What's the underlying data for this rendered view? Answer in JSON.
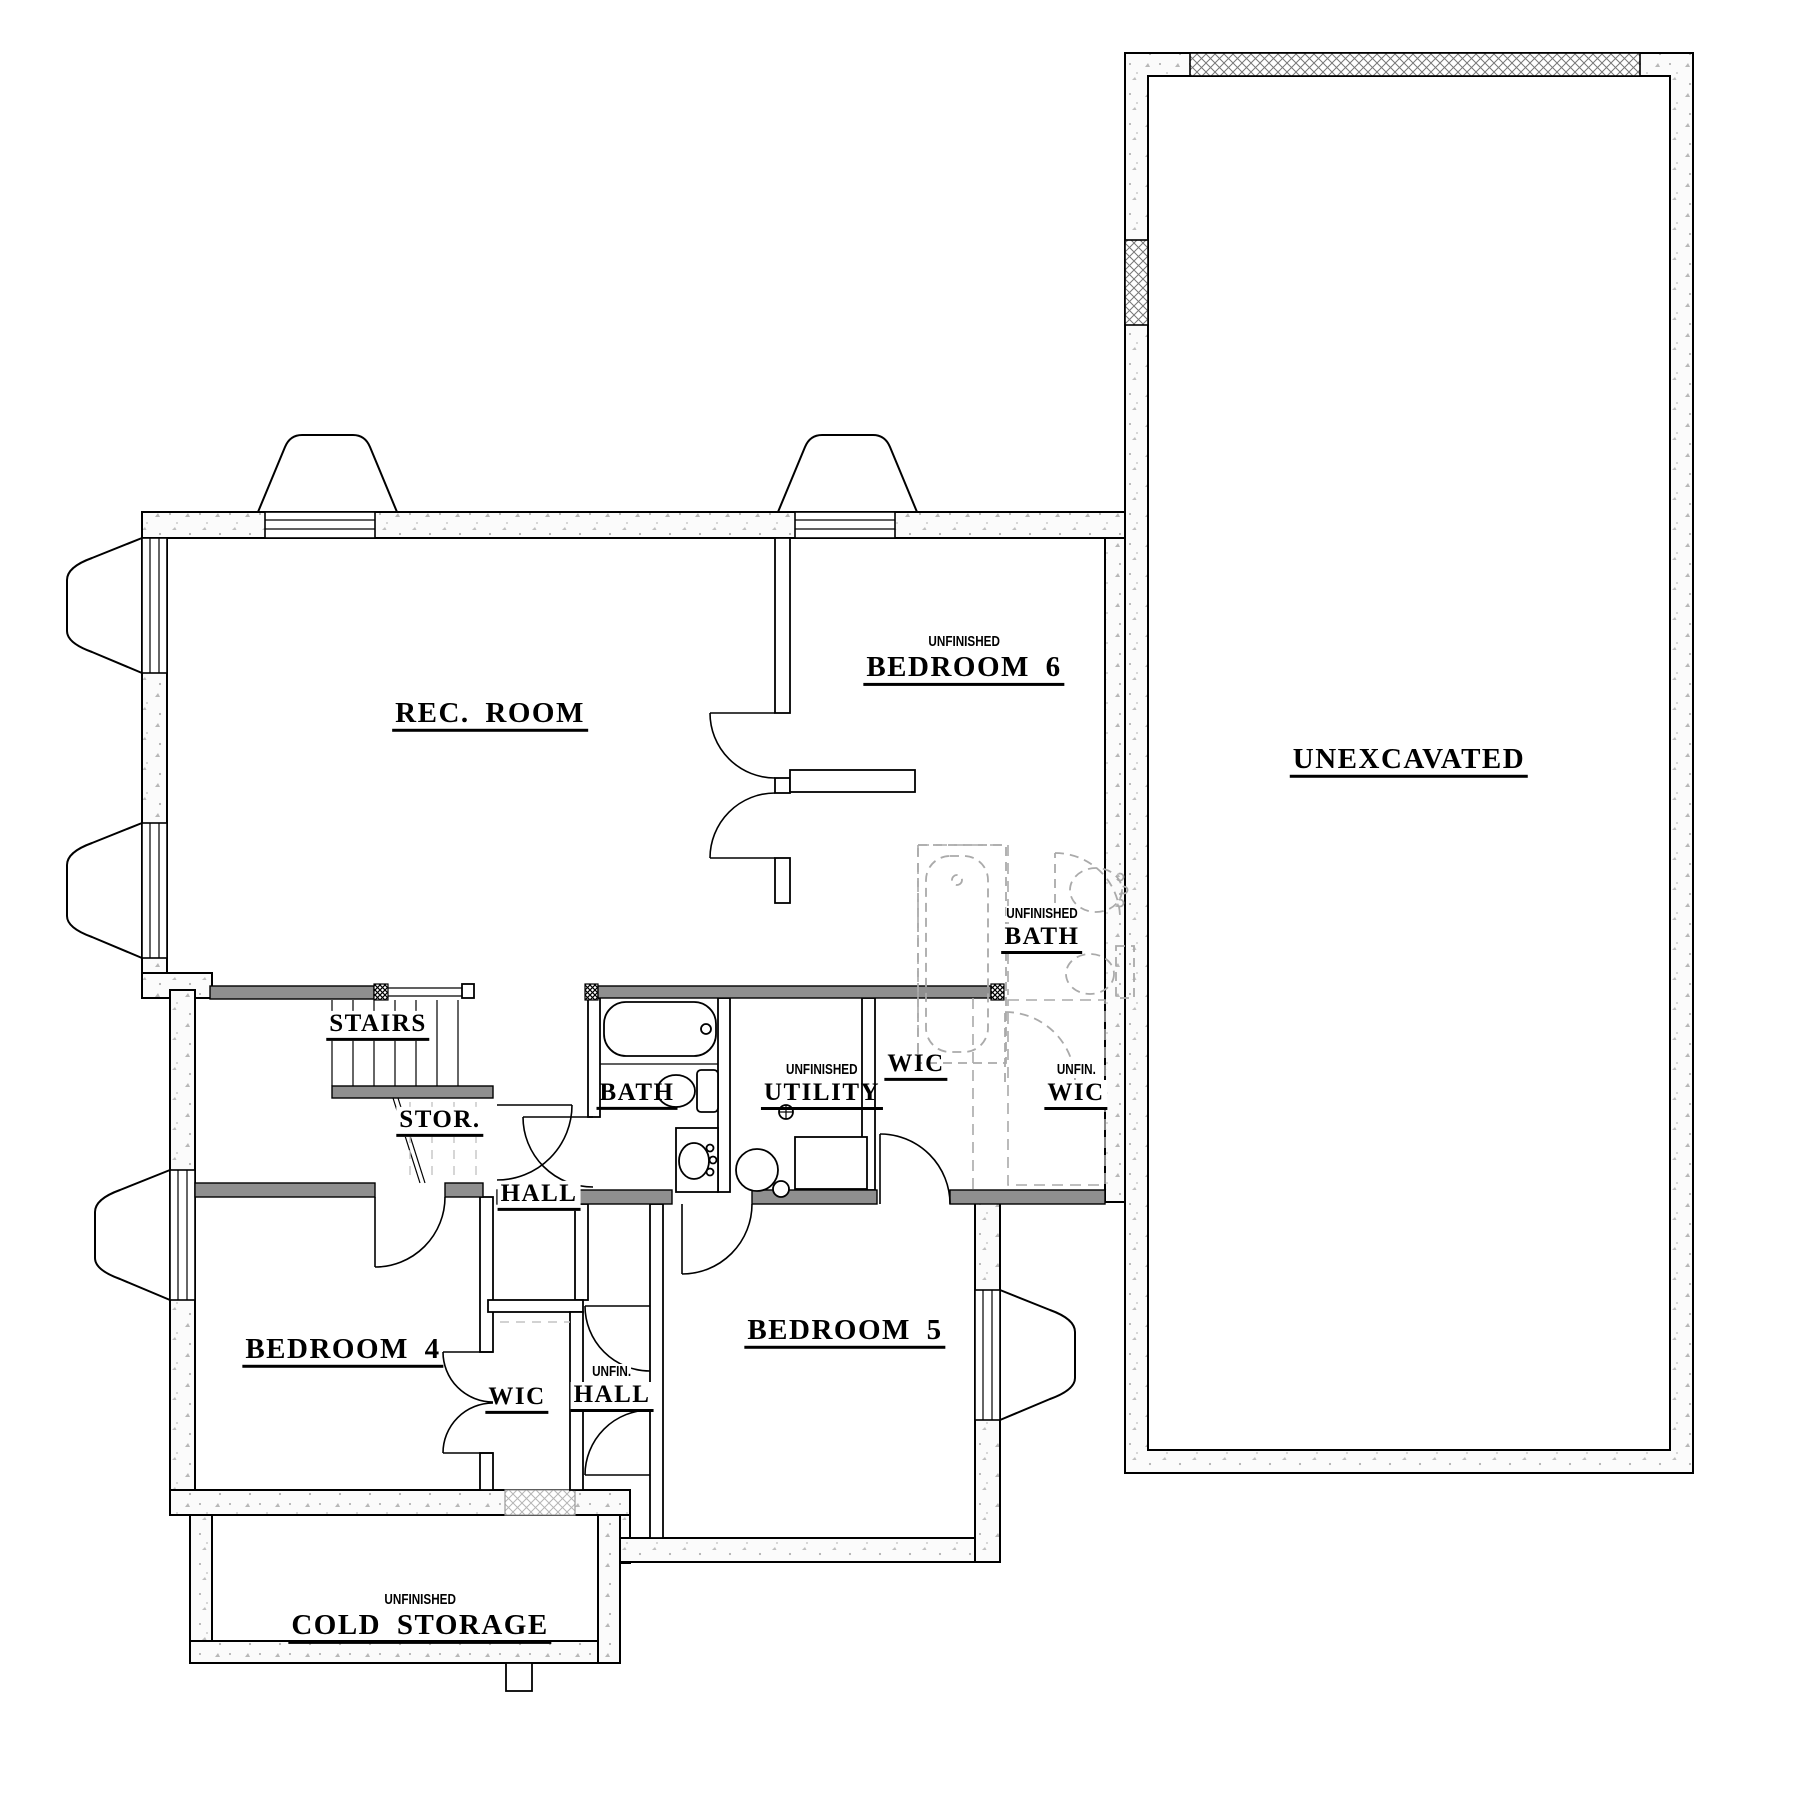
{
  "rooms": {
    "rec_room": {
      "label": "REC. ROOM"
    },
    "bedroom6": {
      "sublabel": "UNFINISHED",
      "label": "BEDROOM 6"
    },
    "unexcavated": {
      "label": "UNEXCAVATED"
    },
    "stairs": {
      "label": "STAIRS"
    },
    "storage": {
      "label": "STOR."
    },
    "hall": {
      "label": "HALL"
    },
    "bath": {
      "label": "BATH"
    },
    "utility": {
      "sublabel": "UNFINISHED",
      "label": "UTILITY"
    },
    "wic_bedroom5": {
      "label": "WIC"
    },
    "unfin_bath": {
      "sublabel": "UNFINISHED",
      "label": "BATH"
    },
    "unfin_wic": {
      "sublabel": "UNFIN.",
      "label": "WIC"
    },
    "bedroom4": {
      "label": "BEDROOM 4"
    },
    "wic_bedroom4": {
      "label": "WIC"
    },
    "unfin_hall": {
      "sublabel": "UNFIN.",
      "label": "HALL"
    },
    "bedroom5": {
      "label": "BEDROOM 5"
    },
    "cold_storage": {
      "sublabel": "UNFINISHED",
      "label": "COLD STORAGE"
    }
  },
  "colors": {
    "wall-gray": "#8f8f8f",
    "line": "#000000",
    "unfinished-dash": "#aaaaaa",
    "paper": "#ffffff"
  }
}
